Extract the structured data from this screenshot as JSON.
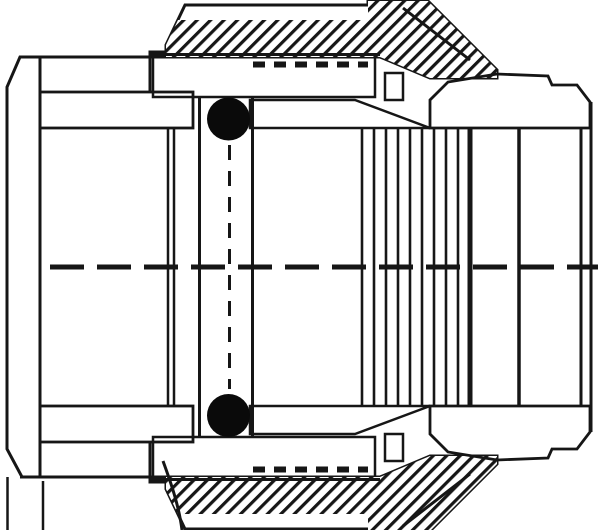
{
  "drawing": {
    "kind": "engineering-cross-section",
    "subject": "pipe-compression-fitting",
    "background": "#ffffff",
    "ink": "#161616",
    "oring_fill": "#0a0a0a",
    "centerline": {
      "y": 267,
      "x1": 50,
      "x2": 598,
      "dash": "34 13",
      "width": 5
    },
    "oring_top": {
      "cx": 228.5,
      "cy": 119,
      "r": 21.5
    },
    "oring_bottom": {
      "cx": 228.5,
      "cy": 415.5,
      "r": 21.5
    },
    "oring_axis_dash": {
      "x": 229.5,
      "y1": 145,
      "y2": 389,
      "dash": "15 11",
      "width": 3
    },
    "hatch": {
      "coarse_spacing": 13,
      "coarse_stripe": 4.5,
      "fine_spacing": 9.5,
      "fine_stripe": 3.2
    },
    "components": [
      "end-cap-socket",
      "cap-outer-shell",
      "compression-nut",
      "grip-ring-stack",
      "thrust-washer-band",
      "o-ring-top",
      "o-ring-bottom",
      "fitting-body",
      "male-end",
      "bore-step-edges",
      "centerline"
    ]
  }
}
